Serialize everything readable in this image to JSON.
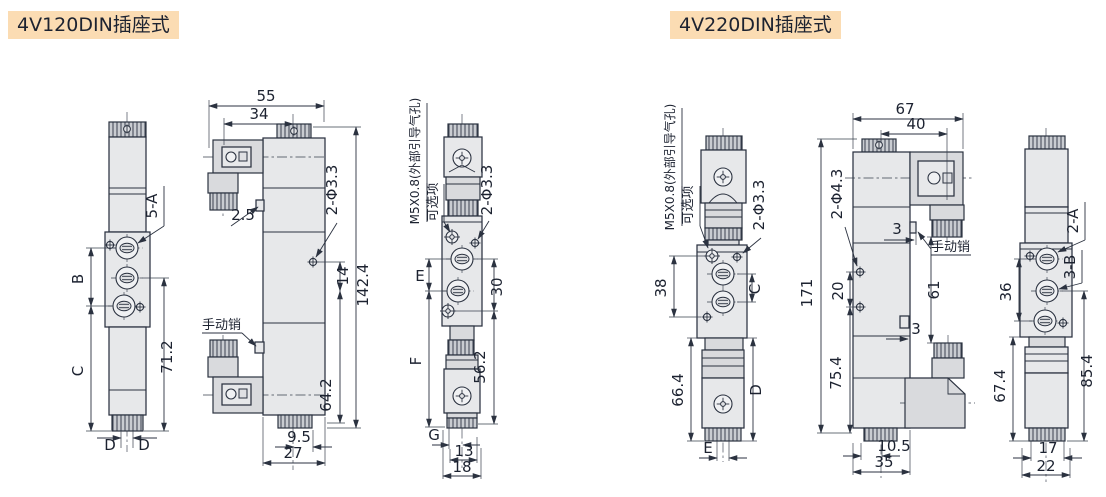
{
  "palette": {
    "title_background": "#fbdcb3",
    "line_color": "#2b3240",
    "body_fill": "#e7e8ea",
    "page_background": "#ffffff"
  },
  "fig120": {
    "title": "4V120DIN插座式",
    "side": {
      "callout_a": "5-A",
      "b": "B",
      "c": "C",
      "h71": "71.2",
      "d1": "D",
      "d2": "D"
    },
    "front": {
      "w55": "55",
      "w34": "34",
      "t2_5": "2.5",
      "holes": "2-Φ3.3",
      "h14": "14",
      "h142": "142.4",
      "pin": "手动销",
      "h64": "64.2",
      "w9_5": "9.5",
      "w27": "27"
    },
    "end": {
      "pilot": "M5X0.8(外部引导气孔)",
      "opt": "可选项",
      "holes": "2-Φ3.3",
      "e": "E",
      "h30": "30",
      "f": "F",
      "h56": "56.2",
      "g": "G",
      "w13": "13",
      "w18": "18"
    }
  },
  "fig220": {
    "title": "4V220DIN插座式",
    "side": {
      "pilot": "M5X0.8(外部引导气孔)",
      "opt": "可选项",
      "holes": "2-Φ3.3",
      "h38": "38",
      "c": "C",
      "h66": "66.4",
      "d": "D",
      "e": "E"
    },
    "front": {
      "w67": "67",
      "w40": "40",
      "holes": "2-Φ4.3",
      "t3a": "3",
      "pin": "手动销",
      "h171": "171",
      "h20": "20",
      "h75": "75.4",
      "h61": "61",
      "t3b": "3",
      "w10_5": "10.5",
      "w35": "35"
    },
    "end": {
      "a": "2-A",
      "b": "3-B",
      "h36": "36",
      "h67": "67.4",
      "h85": "85.4",
      "w17": "17",
      "w22": "22"
    }
  }
}
